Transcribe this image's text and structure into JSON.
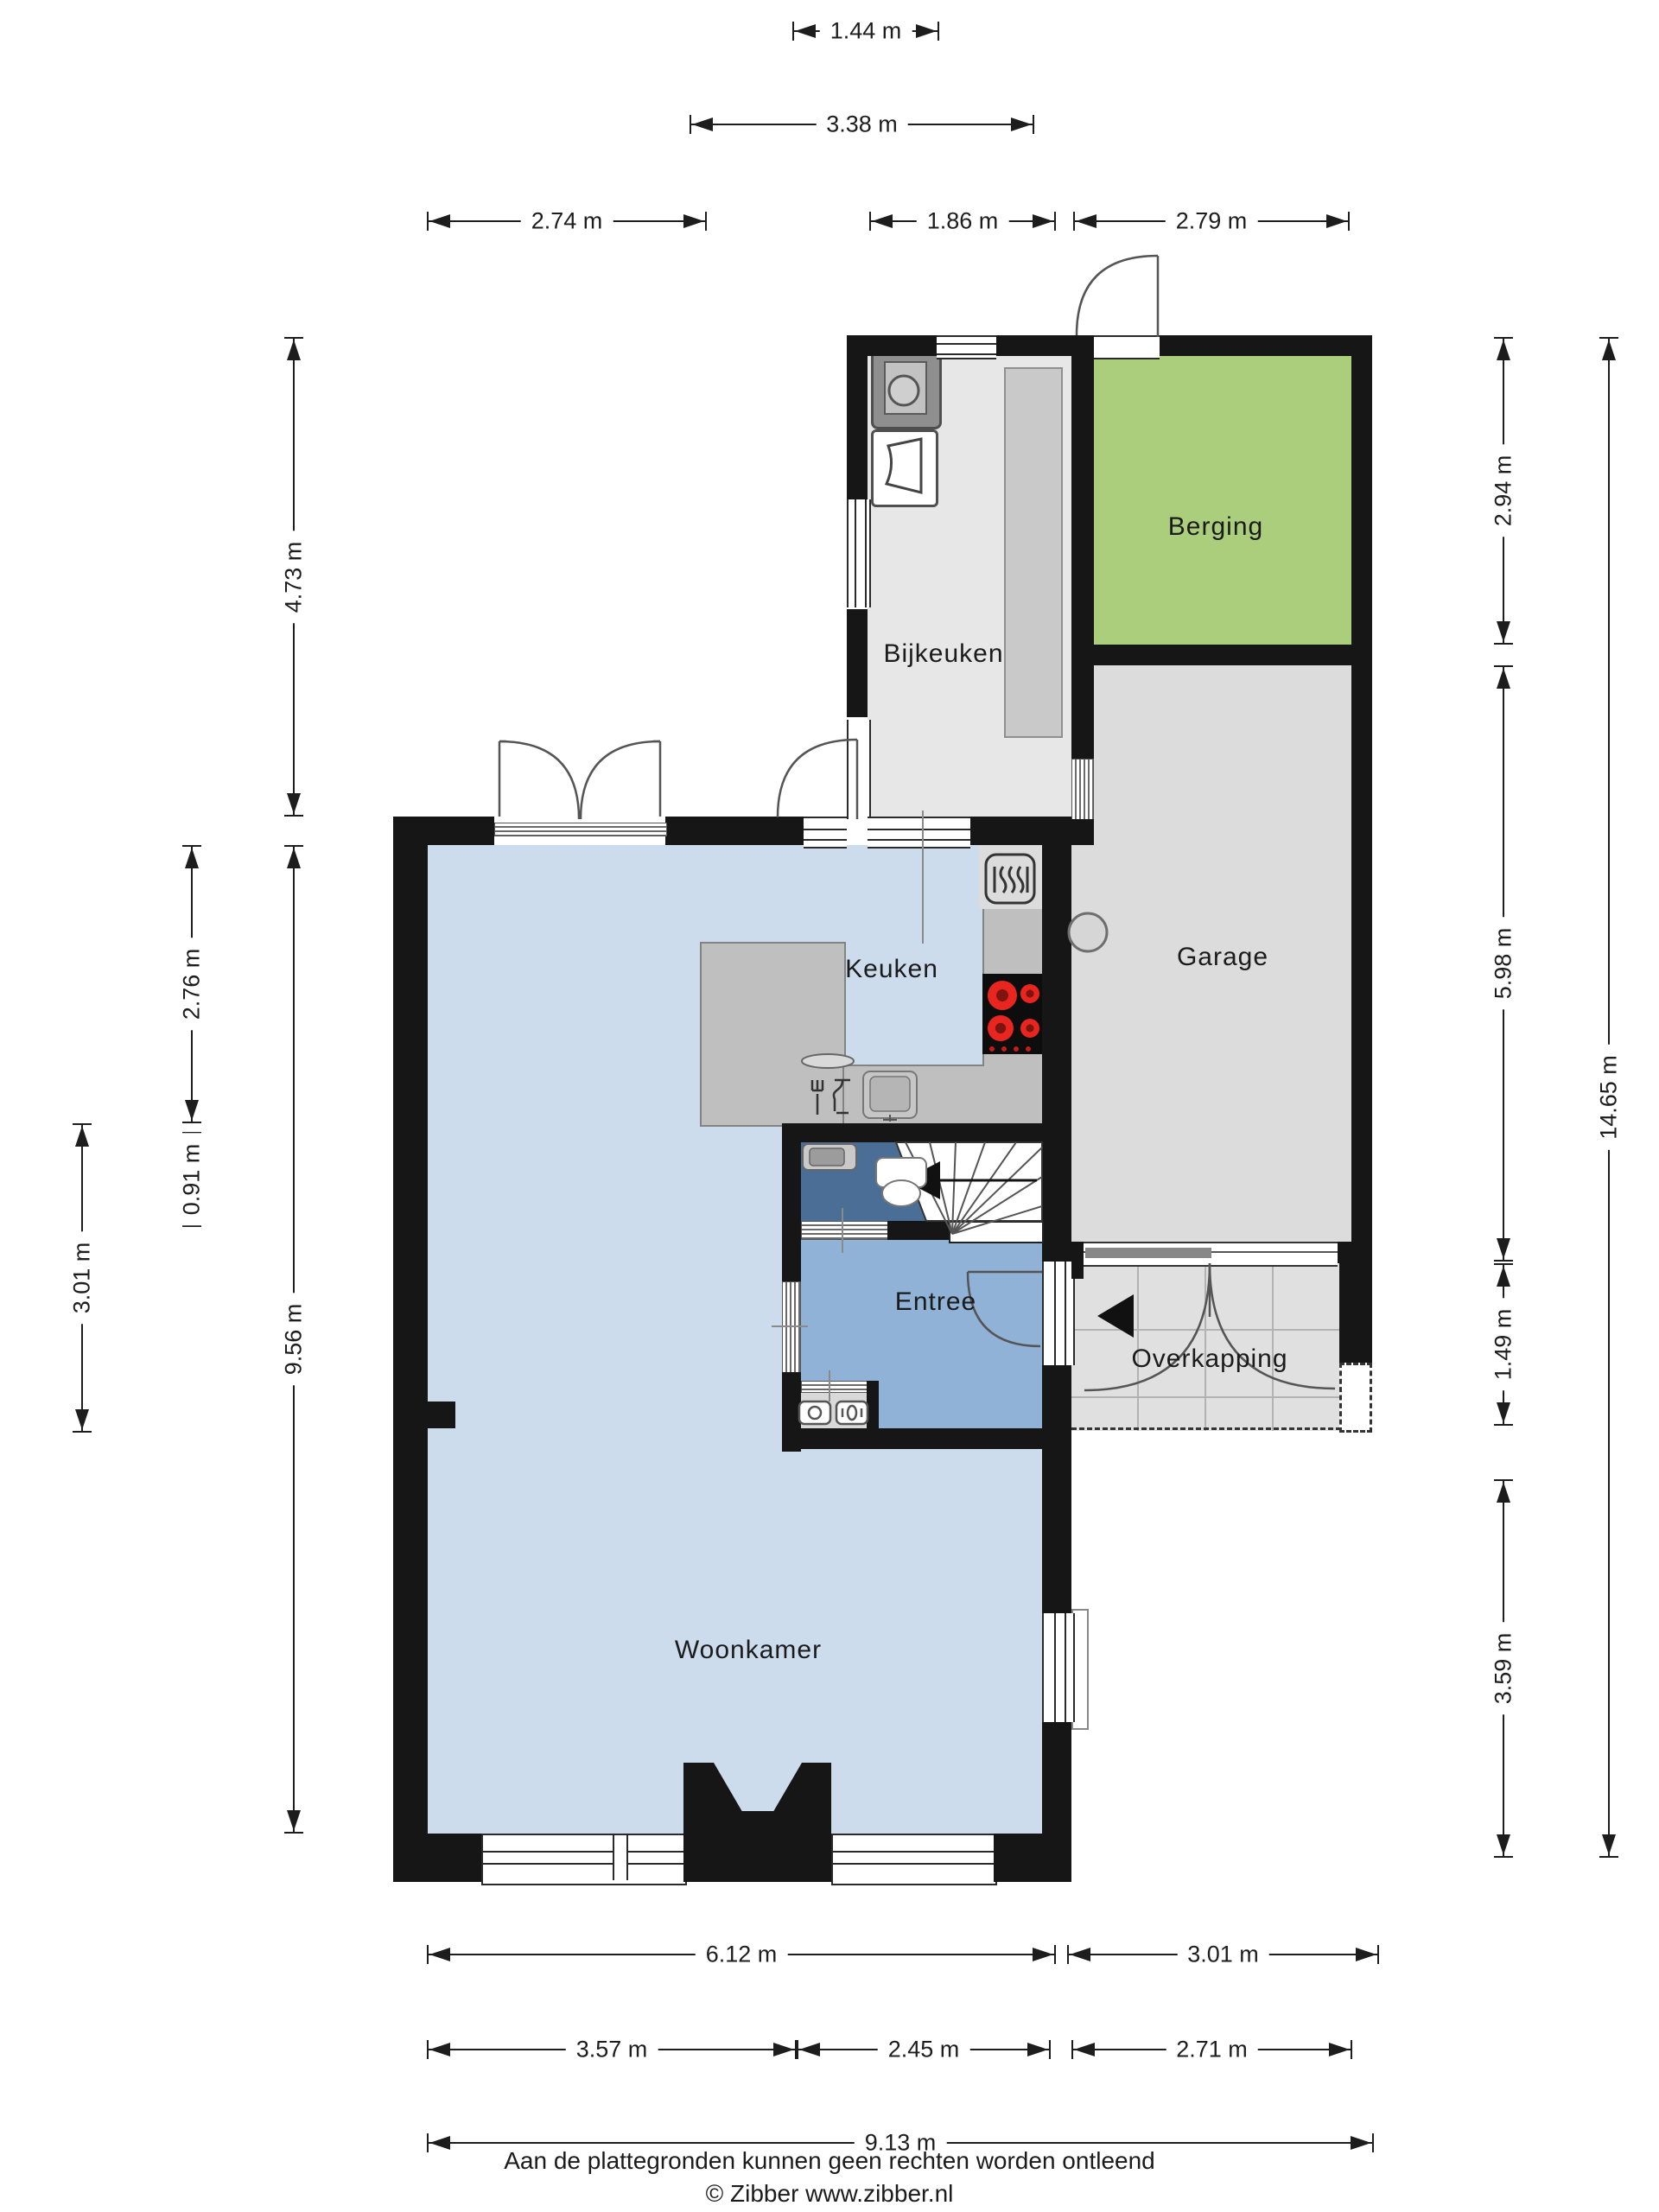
{
  "rooms": {
    "berging": "Berging",
    "bijkeuken": "Bijkeuken",
    "garage": "Garage",
    "keuken": "Keuken",
    "entree": "Entree",
    "overkapping": "Overkapping",
    "woonkamer": "Woonkamer"
  },
  "dims": {
    "d144": "1.44 m",
    "d338": "3.38 m",
    "d274": "2.74 m",
    "d186": "1.86 m",
    "d279": "2.79 m",
    "d473": "4.73 m",
    "d276": "2.76 m",
    "d091": "0.91 m",
    "d301l": "3.01 m",
    "d956": "9.56 m",
    "d294": "2.94 m",
    "d598": "5.98 m",
    "d149": "1.49 m",
    "d359": "3.59 m",
    "d1465": "14.65 m",
    "d612": "6.12 m",
    "d301b": "3.01 m",
    "d357": "3.57 m",
    "d245": "2.45 m",
    "d271": "2.71 m",
    "d913": "9.13 m"
  },
  "footer": {
    "line1": "Aan de plattegronden kunnen geen rechten worden ontleend",
    "line2": "© Zibber www.zibber.nl"
  },
  "colors": {
    "wall": "#161616",
    "living_floor": "#ccdcec",
    "entree_floor": "#8fb2d6",
    "toilet_floor": "#4a6e95",
    "berging_floor": "#abce7c",
    "garage_floor": "#dcdcdc",
    "bijkeuken_floor": "#e7e7e7",
    "counter": "#bfbfbf",
    "overkapping_tiles": "#e0e0e0",
    "burner_red": "#e8251f"
  },
  "icons": [
    "washer-icon",
    "laundry-basket-icon",
    "radiator-icon",
    "hob-icon",
    "kitchen-sink-icon",
    "dishwasher-icon",
    "toilet-icon",
    "hand-basin-icon",
    "meter-icon",
    "stairs-icon",
    "stair-direction-arrow-icon",
    "entrance-arrow-icon",
    "door-arc-icon",
    "wall-column-icon"
  ]
}
